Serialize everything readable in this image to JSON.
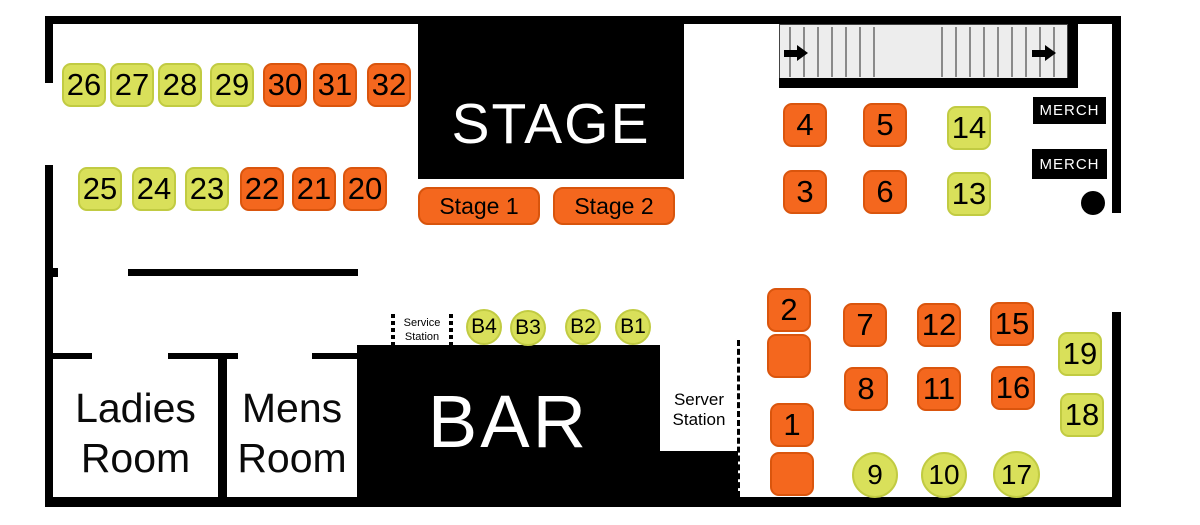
{
  "colors": {
    "orange": "#F4671E",
    "orange_border": "#DA550D",
    "green": "#D9E05A",
    "green_border": "#C1CB42",
    "wall": "#000000"
  },
  "stage": {
    "label": "STAGE",
    "buttons": [
      {
        "label": "Stage 1"
      },
      {
        "label": "Stage 2"
      }
    ]
  },
  "bar": {
    "label": "BAR"
  },
  "rooms": {
    "ladies": {
      "line1": "Ladies",
      "line2": "Room"
    },
    "mens": {
      "line1": "Mens",
      "line2": "Room"
    }
  },
  "stations": {
    "service": {
      "line1": "Service",
      "line2": "Station"
    },
    "server": {
      "line1": "Server",
      "line2": "Station"
    }
  },
  "merch": {
    "0": "MERCH",
    "1": "MERCH"
  },
  "tables": {
    "squares": [
      {
        "label": "26",
        "color": "green",
        "x": 62,
        "y": 63
      },
      {
        "label": "27",
        "color": "green",
        "x": 110,
        "y": 63
      },
      {
        "label": "28",
        "color": "green",
        "x": 158,
        "y": 63
      },
      {
        "label": "29",
        "color": "green",
        "x": 210,
        "y": 63
      },
      {
        "label": "30",
        "color": "orange",
        "x": 263,
        "y": 63
      },
      {
        "label": "31",
        "color": "orange",
        "x": 313,
        "y": 63
      },
      {
        "label": "32",
        "color": "orange",
        "x": 367,
        "y": 63
      },
      {
        "label": "25",
        "color": "green",
        "x": 78,
        "y": 167
      },
      {
        "label": "24",
        "color": "green",
        "x": 132,
        "y": 167
      },
      {
        "label": "23",
        "color": "green",
        "x": 185,
        "y": 167
      },
      {
        "label": "22",
        "color": "orange",
        "x": 240,
        "y": 167
      },
      {
        "label": "21",
        "color": "orange",
        "x": 292,
        "y": 167
      },
      {
        "label": "20",
        "color": "orange",
        "x": 343,
        "y": 167
      },
      {
        "label": "4",
        "color": "orange",
        "x": 783,
        "y": 103
      },
      {
        "label": "5",
        "color": "orange",
        "x": 863,
        "y": 103
      },
      {
        "label": "14",
        "color": "green",
        "x": 947,
        "y": 106
      },
      {
        "label": "3",
        "color": "orange",
        "x": 783,
        "y": 170
      },
      {
        "label": "6",
        "color": "orange",
        "x": 863,
        "y": 170
      },
      {
        "label": "13",
        "color": "green",
        "x": 947,
        "y": 172
      },
      {
        "label": "2",
        "color": "orange",
        "x": 767,
        "y": 288
      },
      {
        "label": "",
        "color": "orange",
        "x": 767,
        "y": 334
      },
      {
        "label": "7",
        "color": "orange",
        "x": 843,
        "y": 303
      },
      {
        "label": "12",
        "color": "orange",
        "x": 917,
        "y": 303
      },
      {
        "label": "15",
        "color": "orange",
        "x": 990,
        "y": 302
      },
      {
        "label": "8",
        "color": "orange",
        "x": 844,
        "y": 367
      },
      {
        "label": "11",
        "color": "orange",
        "x": 917,
        "y": 367
      },
      {
        "label": "16",
        "color": "orange",
        "x": 991,
        "y": 366
      },
      {
        "label": "19",
        "color": "green",
        "x": 1058,
        "y": 332
      },
      {
        "label": "18",
        "color": "green",
        "x": 1060,
        "y": 393
      },
      {
        "label": "1",
        "color": "orange",
        "x": 770,
        "y": 403
      },
      {
        "label": "",
        "color": "orange",
        "x": 770,
        "y": 452
      }
    ],
    "circles": [
      {
        "label": "B4",
        "color": "green",
        "x": 466,
        "y": 309,
        "d": 36
      },
      {
        "label": "B3",
        "color": "green",
        "x": 510,
        "y": 310,
        "d": 36
      },
      {
        "label": "B2",
        "color": "green",
        "x": 565,
        "y": 309,
        "d": 36
      },
      {
        "label": "B1",
        "color": "green",
        "x": 615,
        "y": 309,
        "d": 36
      },
      {
        "label": "9",
        "color": "green",
        "x": 852,
        "y": 452,
        "d": 46
      },
      {
        "label": "10",
        "color": "green",
        "x": 921,
        "y": 452,
        "d": 46
      },
      {
        "label": "17",
        "color": "green",
        "x": 993,
        "y": 451,
        "d": 47
      }
    ]
  }
}
